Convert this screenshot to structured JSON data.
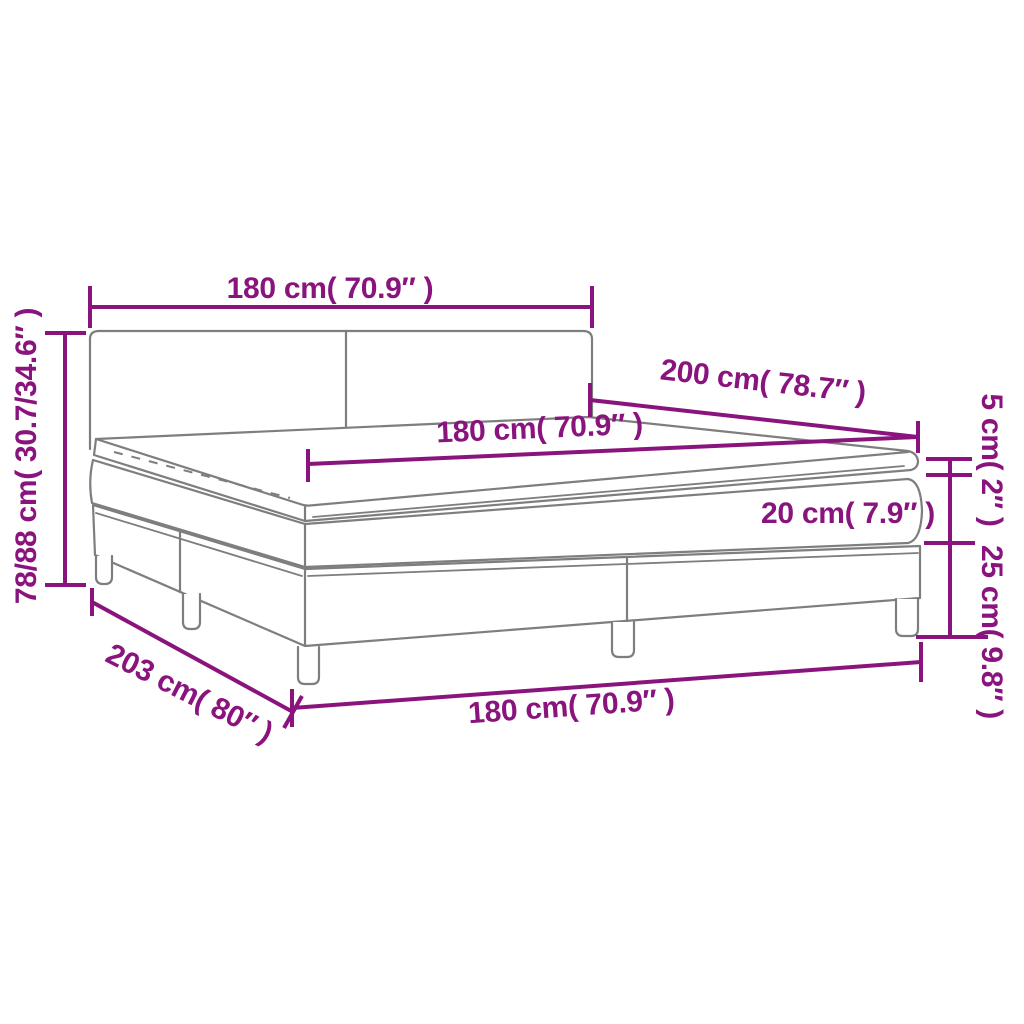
{
  "labels": {
    "headboard_width": "180 cm( 70.9″ )",
    "bed_height": "78/88 cm( 30.7/34.6″ )",
    "bed_length": "200 cm( 78.7″ )",
    "mattress_width": "180 cm( 70.9″ )",
    "topper_height": "5 cm( 2″ )",
    "mattress_height": "20 cm( 7.9″ )",
    "base_height": "25 cm( 9.8″ )",
    "frame_length": "203 cm( 80″ )",
    "frame_width": "180 cm( 70.9″ )"
  },
  "colors": {
    "dimension_accent": "#8A147D",
    "line_art": "#7E7E7E",
    "background": "#FFFFFF"
  }
}
